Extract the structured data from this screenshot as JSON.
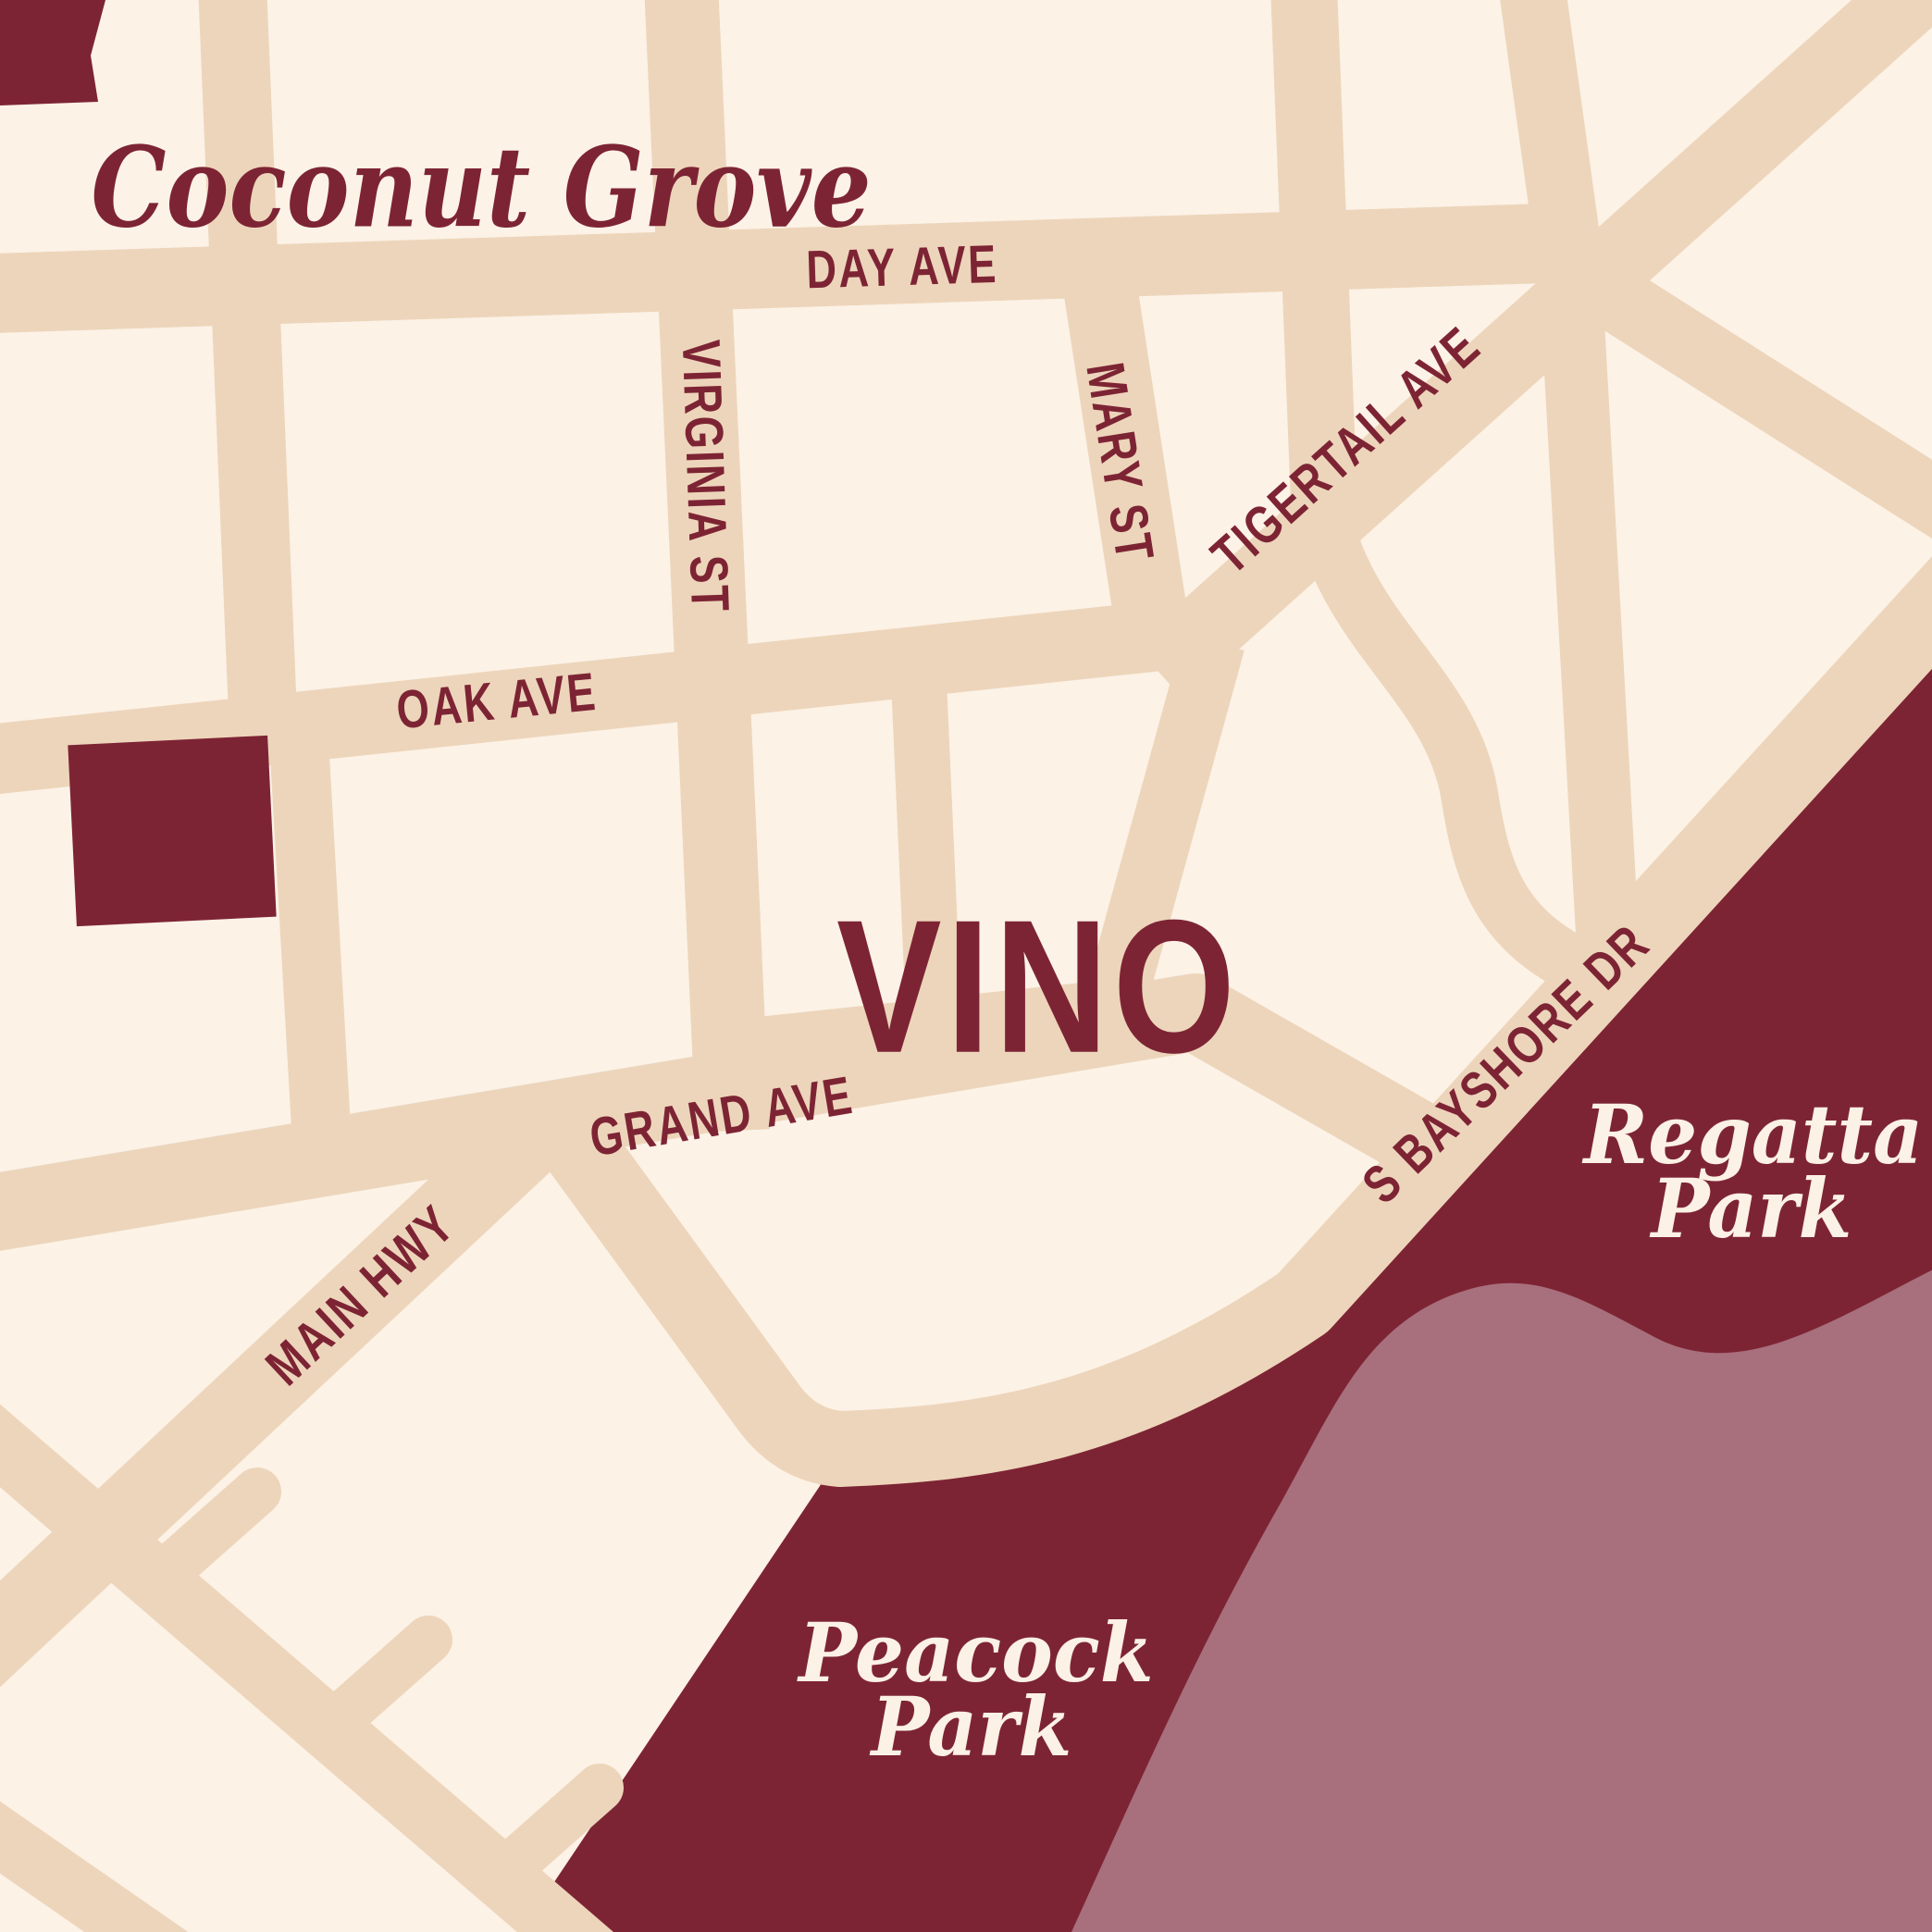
{
  "colors": {
    "bg": "#FCF2E6",
    "road": "#EDD5BB",
    "park": "#7D2434",
    "water": "#A86F7D",
    "ink": "#7D2434",
    "cream": "#FBF1E4"
  },
  "labels": {
    "neighborhood": "Coconut Grove",
    "brand": "VINO",
    "streets": {
      "day_ave": "DAY AVE",
      "virginia_st": "VIRGINIA ST",
      "mary_st": "MARY ST",
      "tigertail_ave": "TIGERTAIL AVE",
      "oak_ave": "OAK AVE",
      "grand_ave": "GRAND AVE",
      "main_hwy": "MAIN HWY",
      "s_bayshore_dr": "S BAYSHORE DR"
    },
    "parks": {
      "regatta": {
        "line1": "Regatta",
        "line2": "Park"
      },
      "peacock": {
        "line1": "Peacock",
        "line2": "Park"
      }
    }
  }
}
